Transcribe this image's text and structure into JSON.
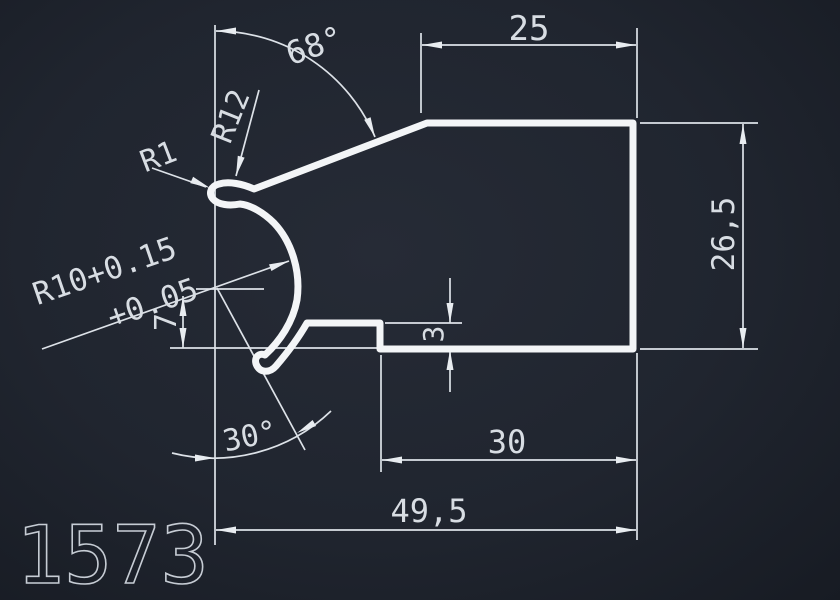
{
  "drawing": {
    "part_number": "1573",
    "dimensions": {
      "top_width": "25",
      "right_height": "26,5",
      "step_depth": "3",
      "mid_width": "30",
      "total_width": "49,5",
      "vertical_offset": "7",
      "angle_top": "68°",
      "angle_bottom": "30°",
      "radius_hook": "R1",
      "radius_bend": "R12",
      "radius_main": "R10+0.15",
      "radius_main_tolerance": "+0.05"
    },
    "colors": {
      "background": "#20252f",
      "thin_line": "#dde2e8",
      "profile_line": "#f3f5f7",
      "text": "#d8dde3"
    }
  }
}
